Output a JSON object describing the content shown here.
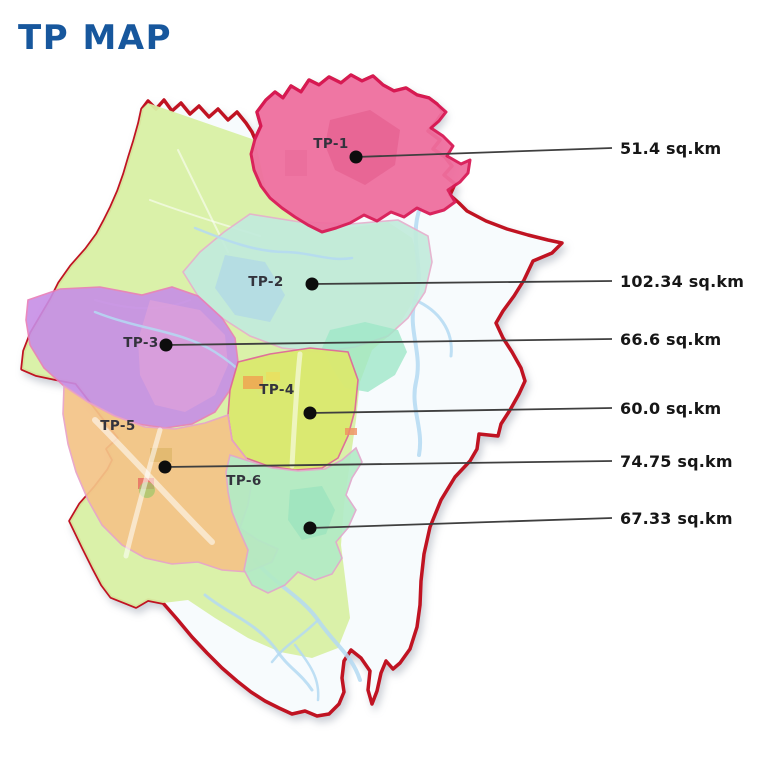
{
  "title": "TP MAP",
  "colors": {
    "title": "#17579d",
    "outer_boundary": "#c01322",
    "map_interior": "#f7fbfd",
    "green_land": "#d8f0a4",
    "river": "#b4d9f2",
    "leader_line": "#3f3f3f",
    "dot": "#0d0d0d",
    "area_label_text": "#161616",
    "region_label_text": "#33333d"
  },
  "regions": [
    {
      "name": "TP-1",
      "area_label": "51.4 sq.km",
      "fill": "#ef6f9f",
      "stroke": "#d91a56"
    },
    {
      "name": "TP-2",
      "area_label": "102.34 sq.km",
      "fill": "#c2ebdc",
      "stroke": "#e5b0cd"
    },
    {
      "name": "TP-3",
      "area_label": "66.6 sq.km",
      "fill": "#c78ee6",
      "stroke": "#e87db8"
    },
    {
      "name": "TP-4",
      "area_label": "60.0 sq.km",
      "fill": "#dbe96f",
      "stroke": "#e06a98"
    },
    {
      "name": "TP-5",
      "area_label": "74.75 sq.km",
      "fill": "#f4c488",
      "stroke": "#e8a3c8"
    },
    {
      "name": "TP-6",
      "area_label": "67.33 sq.km",
      "fill": "#b2ebc6",
      "stroke": "#e0a8cc"
    }
  ]
}
